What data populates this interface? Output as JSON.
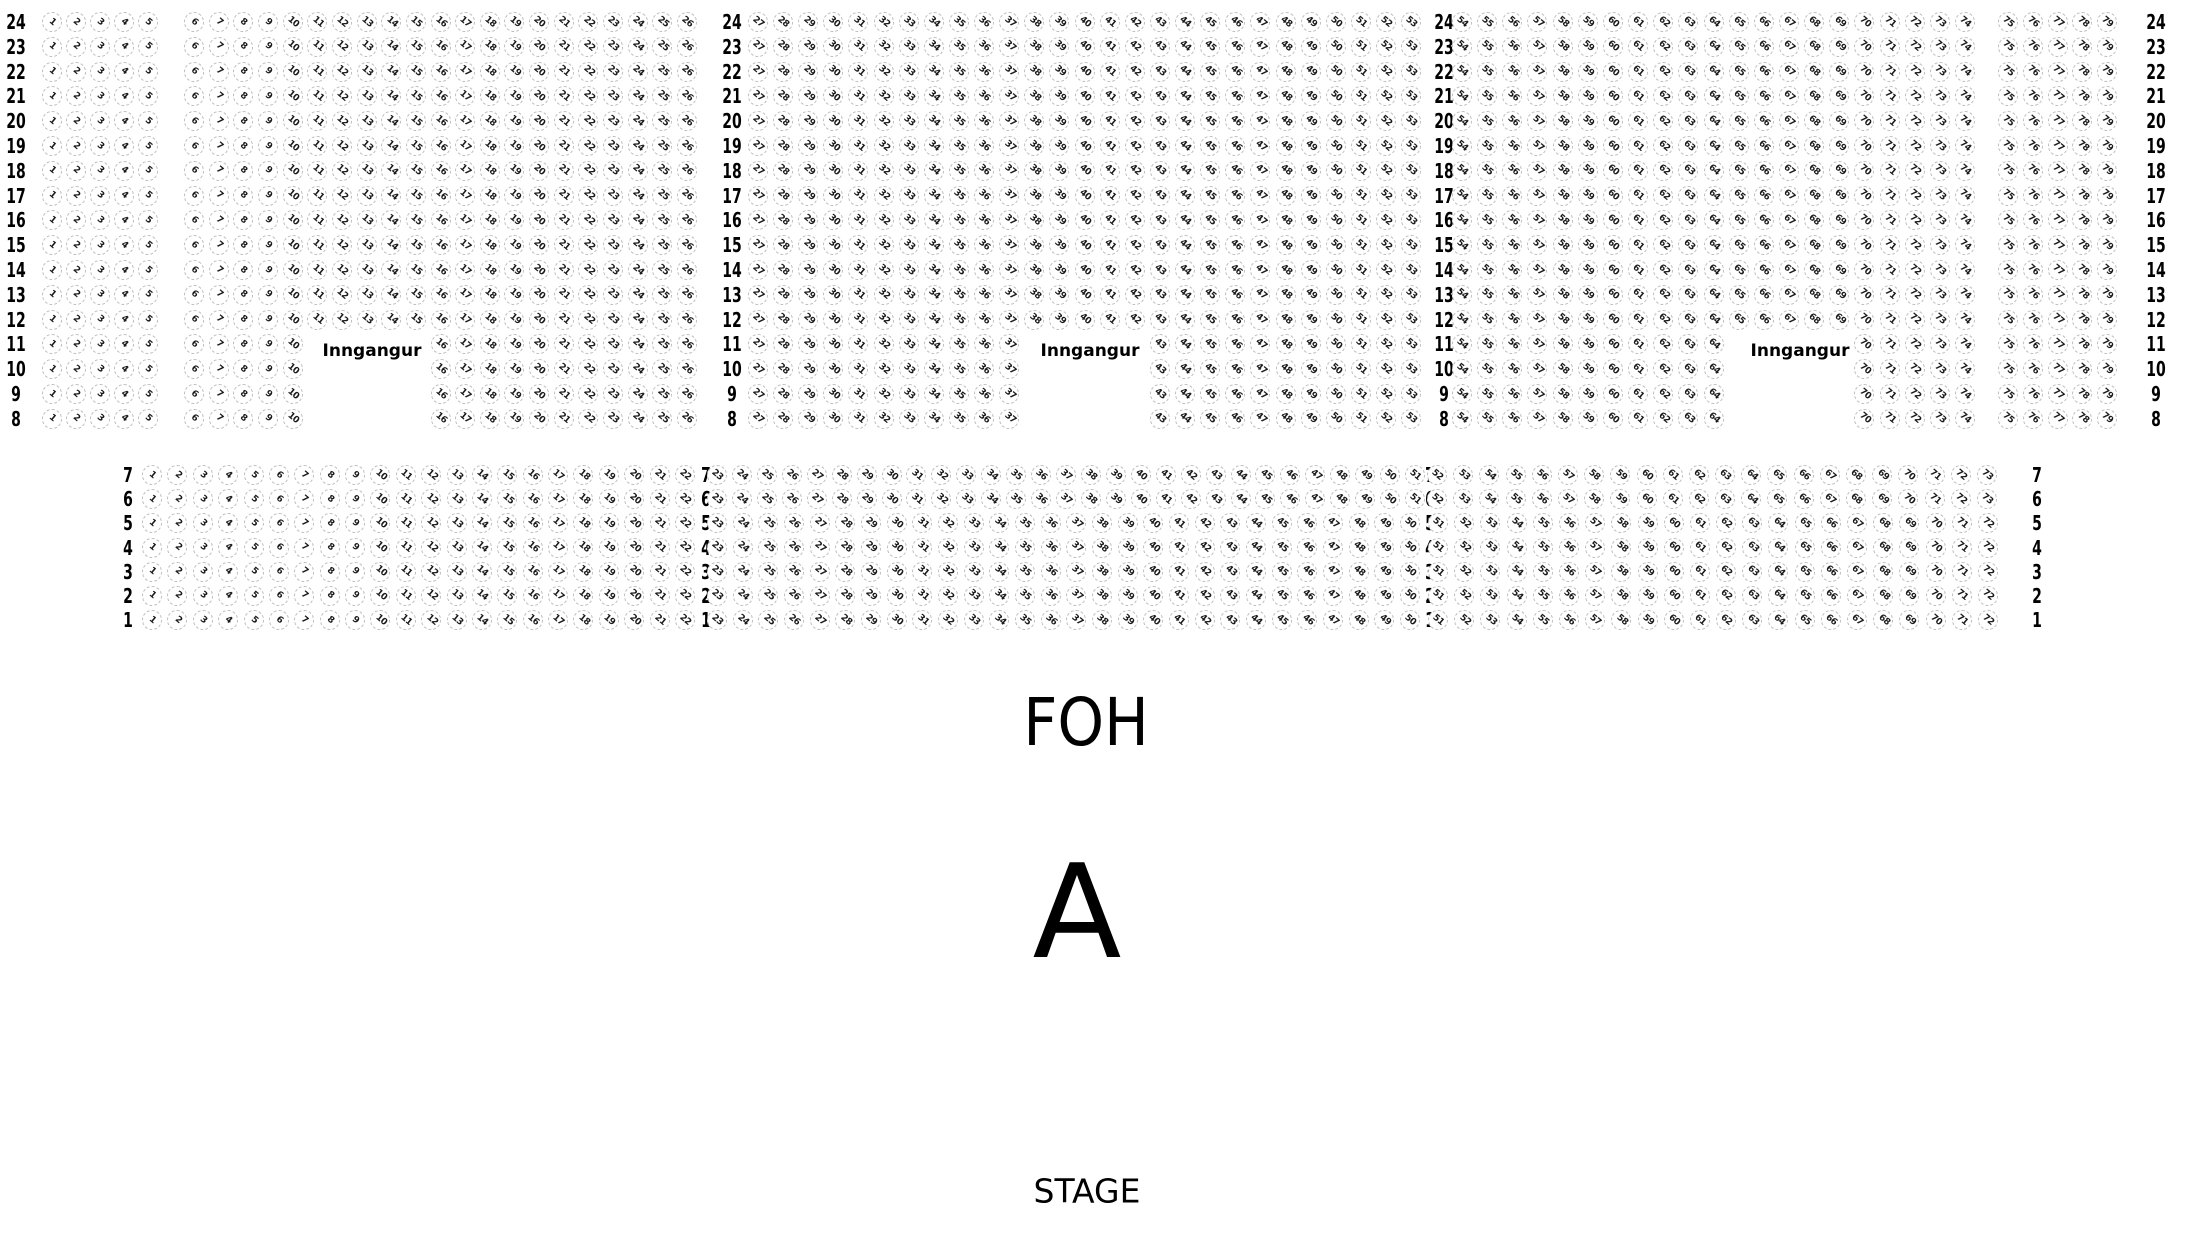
{
  "venue_map": {
    "entrance_label": "Inngangur",
    "foh_label": "FOH",
    "section_letter": "A",
    "stage_label": "STAGE",
    "colors": {
      "background": "#ffffff",
      "seat_border": "#bdbdbd",
      "seat_number": "#1a1a1a",
      "label_text": "#000000"
    },
    "upper_section": {
      "rows": [
        {
          "label": "24",
          "seat_ranges": [
            [
              1,
              5
            ],
            [
              6,
              26
            ],
            [
              27,
              53
            ],
            [
              54,
              74
            ],
            [
              75,
              79
            ]
          ]
        },
        {
          "label": "23",
          "seat_ranges": [
            [
              1,
              5
            ],
            [
              6,
              26
            ],
            [
              27,
              53
            ],
            [
              54,
              74
            ],
            [
              75,
              79
            ]
          ]
        },
        {
          "label": "22",
          "seat_ranges": [
            [
              1,
              5
            ],
            [
              6,
              26
            ],
            [
              27,
              53
            ],
            [
              54,
              74
            ],
            [
              75,
              79
            ]
          ]
        },
        {
          "label": "21",
          "seat_ranges": [
            [
              1,
              5
            ],
            [
              6,
              26
            ],
            [
              27,
              53
            ],
            [
              54,
              74
            ],
            [
              75,
              79
            ]
          ]
        },
        {
          "label": "20",
          "seat_ranges": [
            [
              1,
              5
            ],
            [
              6,
              26
            ],
            [
              27,
              53
            ],
            [
              54,
              74
            ],
            [
              75,
              79
            ]
          ]
        },
        {
          "label": "19",
          "seat_ranges": [
            [
              1,
              5
            ],
            [
              6,
              26
            ],
            [
              27,
              53
            ],
            [
              54,
              74
            ],
            [
              75,
              79
            ]
          ]
        },
        {
          "label": "18",
          "seat_ranges": [
            [
              1,
              5
            ],
            [
              6,
              26
            ],
            [
              27,
              53
            ],
            [
              54,
              74
            ],
            [
              75,
              79
            ]
          ]
        },
        {
          "label": "17",
          "seat_ranges": [
            [
              1,
              5
            ],
            [
              6,
              26
            ],
            [
              27,
              53
            ],
            [
              54,
              74
            ],
            [
              75,
              79
            ]
          ]
        },
        {
          "label": "16",
          "seat_ranges": [
            [
              1,
              5
            ],
            [
              6,
              26
            ],
            [
              27,
              53
            ],
            [
              54,
              74
            ],
            [
              75,
              79
            ]
          ]
        },
        {
          "label": "15",
          "seat_ranges": [
            [
              1,
              5
            ],
            [
              6,
              26
            ],
            [
              27,
              53
            ],
            [
              54,
              74
            ],
            [
              75,
              79
            ]
          ]
        },
        {
          "label": "14",
          "seat_ranges": [
            [
              1,
              5
            ],
            [
              6,
              26
            ],
            [
              27,
              53
            ],
            [
              54,
              74
            ],
            [
              75,
              79
            ]
          ]
        },
        {
          "label": "13",
          "seat_ranges": [
            [
              1,
              5
            ],
            [
              6,
              26
            ],
            [
              27,
              53
            ],
            [
              54,
              74
            ],
            [
              75,
              79
            ]
          ]
        },
        {
          "label": "12",
          "seat_ranges": [
            [
              1,
              5
            ],
            [
              6,
              26
            ],
            [
              27,
              53
            ],
            [
              54,
              74
            ],
            [
              75,
              79
            ]
          ]
        },
        {
          "label": "11",
          "seat_ranges": [
            [
              1,
              5
            ],
            [
              6,
              10
            ],
            [
              16,
              26
            ],
            [
              27,
              37
            ],
            [
              43,
              53
            ],
            [
              54,
              64
            ],
            [
              70,
              74
            ],
            [
              75,
              79
            ]
          ]
        },
        {
          "label": "10",
          "seat_ranges": [
            [
              1,
              5
            ],
            [
              6,
              10
            ],
            [
              16,
              26
            ],
            [
              27,
              37
            ],
            [
              43,
              53
            ],
            [
              54,
              64
            ],
            [
              70,
              74
            ],
            [
              75,
              79
            ]
          ]
        },
        {
          "label": "9",
          "seat_ranges": [
            [
              1,
              5
            ],
            [
              6,
              10
            ],
            [
              16,
              26
            ],
            [
              27,
              37
            ],
            [
              43,
              53
            ],
            [
              54,
              64
            ],
            [
              70,
              74
            ],
            [
              75,
              79
            ]
          ]
        },
        {
          "label": "8",
          "seat_ranges": [
            [
              1,
              5
            ],
            [
              6,
              10
            ],
            [
              16,
              26
            ],
            [
              27,
              37
            ],
            [
              43,
              53
            ],
            [
              54,
              64
            ],
            [
              70,
              74
            ],
            [
              75,
              79
            ]
          ]
        }
      ]
    },
    "lower_section": {
      "rows": [
        {
          "label": "7",
          "seat_ranges": [
            [
              1,
              22
            ],
            [
              23,
              51
            ],
            [
              52,
              73
            ]
          ]
        },
        {
          "label": "6",
          "seat_ranges": [
            [
              1,
              22
            ],
            [
              23,
              51
            ],
            [
              52,
              73
            ]
          ]
        },
        {
          "label": "5",
          "seat_ranges": [
            [
              1,
              22
            ],
            [
              23,
              50
            ],
            [
              51,
              72
            ]
          ]
        },
        {
          "label": "4",
          "seat_ranges": [
            [
              1,
              22
            ],
            [
              23,
              50
            ],
            [
              51,
              72
            ]
          ]
        },
        {
          "label": "3",
          "seat_ranges": [
            [
              1,
              22
            ],
            [
              23,
              50
            ],
            [
              51,
              72
            ]
          ]
        },
        {
          "label": "2",
          "seat_ranges": [
            [
              1,
              22
            ],
            [
              23,
              50
            ],
            [
              51,
              72
            ]
          ]
        },
        {
          "label": "1",
          "seat_ranges": [
            [
              1,
              22
            ],
            [
              23,
              50
            ],
            [
              51,
              72
            ]
          ]
        }
      ]
    },
    "entrances": [
      {
        "label": "Inngangur"
      },
      {
        "label": "Inngangur"
      },
      {
        "label": "Inngangur"
      }
    ]
  }
}
